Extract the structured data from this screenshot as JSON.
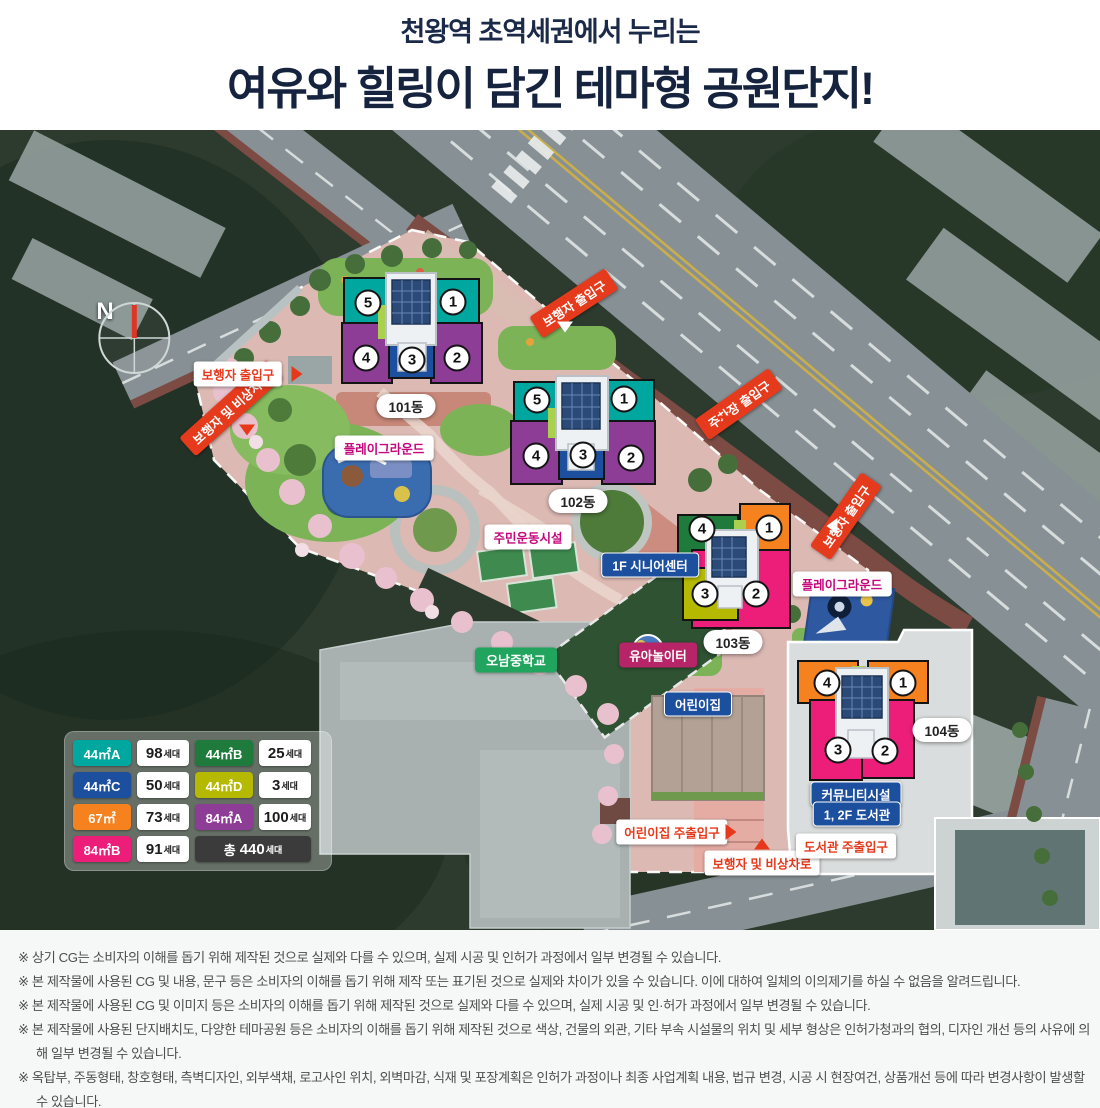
{
  "header": {
    "subtitle": "천왕역 초역세권에서 누리는",
    "title": "여유와 힐링이 담긴 테마형 공원단지!"
  },
  "map": {
    "compass": "N",
    "buildings": [
      {
        "name": "101동",
        "units": [
          "5",
          "1",
          "4",
          "3",
          "2"
        ]
      },
      {
        "name": "102동",
        "units": [
          "5",
          "1",
          "4",
          "3",
          "2"
        ]
      },
      {
        "name": "103동",
        "units": [
          "4",
          "1",
          "3",
          "2"
        ]
      },
      {
        "name": "104동",
        "units": [
          "4",
          "1",
          "3",
          "2"
        ]
      }
    ],
    "labels": {
      "pedestrian_entrance": "보행자 출입구",
      "pedestrian_emergency_road": "보행자 및 비상차로",
      "parking_entrance": "주차장 출입구",
      "playground": "플레이그라운드",
      "residents_sports_facility": "주민운동시설",
      "senior_center": "1F 시니어센터",
      "toddler_playground": "유아놀이터",
      "daycare": "어린이집",
      "daycare_main_entrance": "어린이집 주출입구",
      "library_main_entrance": "도서관 주출입구",
      "community_facility": "커뮤니티시설",
      "library": "1, 2F 도서관",
      "school": "오남중학교"
    }
  },
  "legend": {
    "suffix": "세대",
    "rows": [
      {
        "type": "44㎡A",
        "count": "98",
        "color": "#00a79e"
      },
      {
        "type": "44㎡B",
        "count": "25",
        "color": "#1e7b3c"
      },
      {
        "type": "44㎡C",
        "count": "50",
        "color": "#1c4f9e"
      },
      {
        "type": "44㎡D",
        "count": "3",
        "color": "#b5b900"
      },
      {
        "type": "67㎡",
        "count": "73",
        "color": "#f5821f"
      },
      {
        "type": "84㎡A",
        "count": "100",
        "color": "#8e3d97"
      },
      {
        "type": "84㎡B",
        "count": "91",
        "color": "#ec1e79"
      }
    ],
    "total_prefix": "총",
    "total_count": "440"
  },
  "footer": {
    "marker": "※",
    "disclaimers": [
      "상기 CG는 소비자의 이해를 돕기 위해 제작된 것으로 실제와 다를 수 있으며, 실제 시공 및 인허가 과정에서 일부 변경될 수 있습니다.",
      "본 제작물에 사용된 CG 및 내용, 문구 등은 소비자의 이해를 돕기 위해 제작 또는 표기된 것으로 실제와 차이가 있을 수 있습니다. 이에 대하여 일체의 이의제기를 하실 수 없음을 알려드립니다.",
      "본 제작물에 사용된 CG 및 이미지 등은 소비자의 이해를 돕기 위해 제작된 것으로 실제와 다를 수 있으며, 실제 시공 및 인·허가 과정에서 일부 변경될 수 있습니다.",
      "본 제작물에 사용된 단지배치도, 다양한 테마공원 등은 소비자의 이해를 돕기 위해 제작된 것으로 색상, 건물의 외관, 기타 부속 시설물의 위치 및 세부 형상은 인허가청과의 협의, 디자인 개선 등의 사유에 의해 일부 변경될 수 있습니다.",
      "옥탑부, 주동형태, 창호형태, 측벽디자인, 외부색채, 로고사인 위치, 외벽마감, 식재 및 포장계획은 인허가 과정이나 최종 사업계획 내용, 법규 변경, 시공 시 현장여건, 상품개선 등에 따라 변경사항이 발생할 수 있습니다."
    ]
  }
}
